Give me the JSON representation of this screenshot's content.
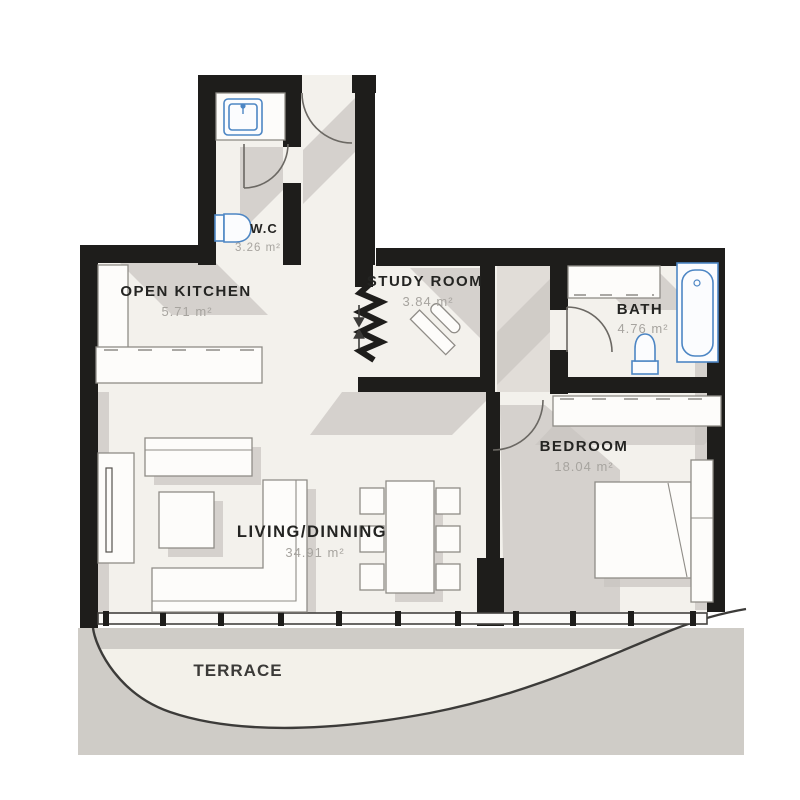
{
  "plan": {
    "rooms": {
      "wc": {
        "name": "W.C",
        "area": "3.26 m²"
      },
      "kitchen": {
        "name": "OPEN KITCHEN",
        "area": "5.71 m²"
      },
      "study": {
        "name": "STUDY ROOM",
        "area": "3.84 m²"
      },
      "bath": {
        "name": "BATH",
        "area": "4.76 m²"
      },
      "bedroom": {
        "name": "BEDROOM",
        "area": "18.04 m²"
      },
      "living": {
        "name": "LIVING/DINNING",
        "area": "34.91 m²"
      },
      "terrace": {
        "name": "TERRACE"
      }
    },
    "colors": {
      "wall": "#1e1d1b",
      "floor": "#f3f1ec",
      "shadow": "#c9c5c0",
      "outside_gray": "#cfccc7",
      "fixture_blue": "#4d86c4",
      "room_label": "#242422",
      "area_label": "#a7a49f"
    }
  }
}
